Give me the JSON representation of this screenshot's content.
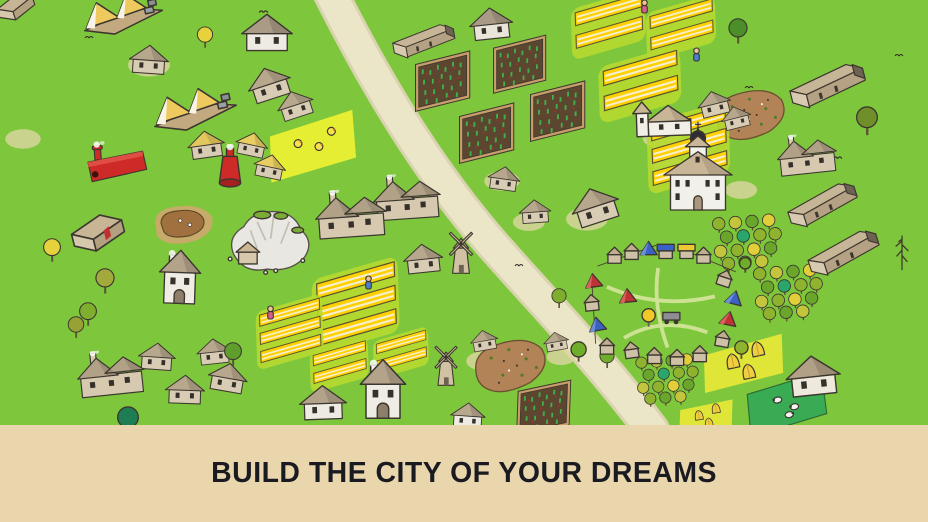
{
  "banner": {
    "text": "BUILD THE CITY OF YOUR DREAMS",
    "bg_color": "#e9d6ac",
    "text_color": "#1a1a21"
  },
  "map": {
    "grass_color": "#7ec73d",
    "road_color": "#ece6c8",
    "road_edge_color": "#d9d3b0",
    "road_path": "M 328,-12 C 376,84 428,170 492,244 C 550,310 596,356 652,430",
    "objects": [
      {
        "t": "patch",
        "x": 120,
        "y": 52,
        "w": 58,
        "h": 26
      },
      {
        "t": "patch",
        "x": 0,
        "y": 128,
        "w": 46,
        "h": 22
      },
      {
        "t": "patch",
        "x": 478,
        "y": 170,
        "w": 48,
        "h": 22
      },
      {
        "t": "patch",
        "x": 506,
        "y": 212,
        "w": 46,
        "h": 20
      },
      {
        "t": "patch",
        "x": 556,
        "y": 206,
        "w": 62,
        "h": 26
      },
      {
        "t": "patch",
        "x": 634,
        "y": 126,
        "w": 56,
        "h": 24
      },
      {
        "t": "patch",
        "x": 692,
        "y": 102,
        "w": 62,
        "h": 26
      },
      {
        "t": "patch",
        "x": 646,
        "y": 156,
        "w": 46,
        "h": 20
      },
      {
        "t": "patch",
        "x": 716,
        "y": 180,
        "w": 50,
        "h": 20
      },
      {
        "t": "patch",
        "x": 458,
        "y": 350,
        "w": 52,
        "h": 22
      },
      {
        "t": "patch",
        "x": 540,
        "y": 348,
        "w": 42,
        "h": 18
      },
      {
        "t": "mudpit",
        "x": 150,
        "y": 198,
        "w": 66,
        "h": 52,
        "r": 0
      },
      {
        "t": "dirt",
        "x": 706,
        "y": 86,
        "w": 88,
        "h": 58,
        "r": -8
      },
      {
        "t": "dirt",
        "x": 466,
        "y": 336,
        "w": 88,
        "h": 60,
        "r": -10
      },
      {
        "t": "crop",
        "x": 402,
        "y": 56,
        "w": 80,
        "h": 52,
        "r": -14
      },
      {
        "t": "crop",
        "x": 480,
        "y": 40,
        "w": 78,
        "h": 50,
        "r": -14
      },
      {
        "t": "crop",
        "x": 446,
        "y": 108,
        "w": 80,
        "h": 52,
        "r": -14
      },
      {
        "t": "crop",
        "x": 516,
        "y": 86,
        "w": 82,
        "h": 52,
        "r": -14
      },
      {
        "t": "crop",
        "x": 500,
        "y": 384,
        "w": 86,
        "h": 50,
        "r": -12
      },
      {
        "t": "chickfield",
        "x": 262,
        "y": 118,
        "w": 102,
        "h": 58,
        "r": -14
      },
      {
        "t": "wheat3",
        "x": 294,
        "y": 268,
        "w": 114,
        "h": 78,
        "r": -16
      },
      {
        "t": "wheat3",
        "x": 242,
        "y": 298,
        "w": 88,
        "h": 70,
        "r": -16
      },
      {
        "t": "wheat3",
        "x": 608,
        "y": 114,
        "w": 152,
        "h": 70,
        "r": -16
      },
      {
        "t": "wheat2",
        "x": 556,
        "y": -6,
        "w": 94,
        "h": 64,
        "r": -16
      },
      {
        "t": "wheat2",
        "x": 632,
        "y": -2,
        "w": 88,
        "h": 62,
        "r": -16
      },
      {
        "t": "wheat2",
        "x": 582,
        "y": 56,
        "w": 104,
        "h": 60,
        "r": -16
      },
      {
        "t": "wheat2",
        "x": 298,
        "y": 338,
        "w": 74,
        "h": 56,
        "r": -16
      },
      {
        "t": "wheat2",
        "x": 362,
        "y": 328,
        "w": 70,
        "h": 52,
        "r": -16
      },
      {
        "t": "hayfield",
        "x": 698,
        "y": 340,
        "w": 94,
        "h": 46,
        "r": -12
      },
      {
        "t": "hayfield",
        "x": 668,
        "y": 402,
        "w": 78,
        "h": 30,
        "r": -8
      },
      {
        "t": "pasture",
        "x": 738,
        "y": 378,
        "w": 98,
        "h": 52,
        "r": -12
      },
      {
        "t": "orchard",
        "x": 706,
        "y": 212,
        "w": 84,
        "h": 64,
        "r": -4
      },
      {
        "t": "orchard",
        "x": 746,
        "y": 262,
        "w": 86,
        "h": 64,
        "r": -4
      },
      {
        "t": "orchard",
        "x": 626,
        "y": 352,
        "w": 84,
        "h": 58,
        "r": -4
      },
      {
        "t": "shed",
        "x": -4,
        "y": -8,
        "w": 40,
        "h": 30,
        "r": -18
      },
      {
        "t": "tent",
        "x": 76,
        "y": -8,
        "w": 92,
        "h": 42,
        "r": -12
      },
      {
        "t": "tent",
        "x": 148,
        "y": 86,
        "w": 92,
        "h": 44,
        "r": -12
      },
      {
        "t": "house",
        "x": 128,
        "y": 42,
        "w": 42,
        "h": 34,
        "r": 4
      },
      {
        "t": "house",
        "x": 240,
        "y": 8,
        "w": 54,
        "h": 48,
        "r": 0,
        "c": {
          "wall": "#eeebe3",
          "roof": "#a99b86"
        }
      },
      {
        "t": "house",
        "x": 244,
        "y": 64,
        "w": 50,
        "h": 38,
        "r": -18
      },
      {
        "t": "house",
        "x": 274,
        "y": 88,
        "w": 42,
        "h": 32,
        "r": -18
      },
      {
        "t": "longbarn",
        "x": 388,
        "y": 20,
        "w": 72,
        "h": 44,
        "r": -10
      },
      {
        "t": "house",
        "x": 468,
        "y": 2,
        "w": 46,
        "h": 42,
        "r": -6,
        "c": {
          "wall": "#e9e5db",
          "roof": "#a89a85"
        }
      },
      {
        "t": "house",
        "x": 186,
        "y": 128,
        "w": 40,
        "h": 32,
        "r": -8,
        "c": {
          "roof": "#e3c85e"
        }
      },
      {
        "t": "house",
        "x": 234,
        "y": 130,
        "w": 36,
        "h": 28,
        "r": 12,
        "c": {
          "roof": "#e8cd62"
        }
      },
      {
        "t": "house",
        "x": 252,
        "y": 152,
        "w": 36,
        "h": 28,
        "r": 12,
        "c": {
          "roof": "#e8cd62"
        }
      },
      {
        "t": "factory",
        "x": 84,
        "y": 138,
        "w": 68,
        "h": 54,
        "r": -4
      },
      {
        "t": "kiln",
        "x": 214,
        "y": 144,
        "w": 32,
        "h": 46,
        "r": 0
      },
      {
        "t": "shed",
        "x": 70,
        "y": 212,
        "w": 56,
        "h": 42,
        "r": -14,
        "c": {
          "door": "#c03030"
        }
      },
      {
        "t": "quarry",
        "x": 220,
        "y": 202,
        "w": 98,
        "h": 80,
        "r": 0
      },
      {
        "t": "tallhouse",
        "x": 156,
        "y": 242,
        "w": 48,
        "h": 68,
        "r": 2
      },
      {
        "t": "bighouse",
        "x": 314,
        "y": 184,
        "w": 74,
        "h": 64,
        "r": -4
      },
      {
        "t": "bighouse",
        "x": 372,
        "y": 170,
        "w": 70,
        "h": 58,
        "r": -4
      },
      {
        "t": "house",
        "x": 402,
        "y": 240,
        "w": 42,
        "h": 36,
        "r": -6
      },
      {
        "t": "windmill",
        "x": 440,
        "y": 226,
        "w": 42,
        "h": 54,
        "r": 0
      },
      {
        "t": "house",
        "x": 486,
        "y": 164,
        "w": 36,
        "h": 28,
        "r": 8
      },
      {
        "t": "house",
        "x": 518,
        "y": 196,
        "w": 34,
        "h": 30,
        "r": -4
      },
      {
        "t": "house",
        "x": 568,
        "y": 184,
        "w": 54,
        "h": 42,
        "r": -18
      },
      {
        "t": "chapel",
        "x": 632,
        "y": 94,
        "w": 64,
        "h": 48,
        "r": -2
      },
      {
        "t": "church",
        "x": 656,
        "y": 120,
        "w": 84,
        "h": 100,
        "r": 0
      },
      {
        "t": "house",
        "x": 696,
        "y": 88,
        "w": 36,
        "h": 30,
        "r": -14
      },
      {
        "t": "house",
        "x": 720,
        "y": 104,
        "w": 32,
        "h": 26,
        "r": -14
      },
      {
        "t": "longbarn",
        "x": 784,
        "y": 62,
        "w": 88,
        "h": 50,
        "r": -14
      },
      {
        "t": "bighouse",
        "x": 776,
        "y": 126,
        "w": 62,
        "h": 60,
        "r": -6
      },
      {
        "t": "longbarn",
        "x": 782,
        "y": 180,
        "w": 82,
        "h": 52,
        "r": -18
      },
      {
        "t": "longbarn",
        "x": 802,
        "y": 228,
        "w": 84,
        "h": 52,
        "r": -18
      },
      {
        "t": "market",
        "x": 562,
        "y": 232,
        "w": 196,
        "h": 142,
        "r": 0
      },
      {
        "t": "bighouse",
        "x": 76,
        "y": 344,
        "w": 70,
        "h": 62,
        "r": -6
      },
      {
        "t": "house",
        "x": 136,
        "y": 340,
        "w": 42,
        "h": 32,
        "r": 4
      },
      {
        "t": "house",
        "x": 194,
        "y": 336,
        "w": 40,
        "h": 30,
        "r": -6
      },
      {
        "t": "house",
        "x": 164,
        "y": 372,
        "w": 42,
        "h": 34,
        "r": 2
      },
      {
        "t": "house",
        "x": 206,
        "y": 360,
        "w": 44,
        "h": 34,
        "r": 10
      },
      {
        "t": "house",
        "x": 298,
        "y": 380,
        "w": 50,
        "h": 44,
        "r": -2,
        "c": {
          "wall": "#eeebe3",
          "roof": "#b3a38b"
        }
      },
      {
        "t": "tallhouse",
        "x": 356,
        "y": 354,
        "w": 54,
        "h": 68,
        "r": 0
      },
      {
        "t": "windmill",
        "x": 426,
        "y": 340,
        "w": 40,
        "h": 52,
        "r": 0
      },
      {
        "t": "house",
        "x": 446,
        "y": 400,
        "w": 44,
        "h": 30,
        "r": 4,
        "c": {
          "wall": "#eeebe3"
        }
      },
      {
        "t": "house",
        "x": 468,
        "y": 328,
        "w": 32,
        "h": 24,
        "r": -10
      },
      {
        "t": "house",
        "x": 542,
        "y": 330,
        "w": 28,
        "h": 22,
        "r": -10
      },
      {
        "t": "house",
        "x": 784,
        "y": 348,
        "w": 58,
        "h": 54,
        "r": -6,
        "c": {
          "wall": "#efe9dd",
          "roof": "#b2a086"
        }
      },
      {
        "t": "tree",
        "x": 196,
        "y": 26,
        "w": 18,
        "h": 24,
        "c": {
          "leaf": "#e5d23c"
        }
      },
      {
        "t": "tree",
        "x": 42,
        "y": 238,
        "w": 20,
        "h": 26,
        "c": {
          "leaf": "#e5d23c"
        }
      },
      {
        "t": "tree",
        "x": 94,
        "y": 268,
        "w": 22,
        "h": 28,
        "c": {
          "leaf": "#a3a93a"
        }
      },
      {
        "t": "tree",
        "x": 78,
        "y": 302,
        "w": 20,
        "h": 26,
        "c": {
          "leaf": "#7fae2f"
        }
      },
      {
        "t": "tree",
        "x": 66,
        "y": 316,
        "w": 20,
        "h": 24,
        "c": {
          "leaf": "#97a135"
        }
      },
      {
        "t": "tree",
        "x": 222,
        "y": 342,
        "w": 22,
        "h": 26,
        "c": {
          "leaf": "#5f9e2d"
        }
      },
      {
        "t": "tree",
        "x": 114,
        "y": 406,
        "w": 28,
        "h": 32,
        "c": {
          "leaf": "#1f7d54"
        }
      },
      {
        "t": "tree",
        "x": 726,
        "y": 18,
        "w": 24,
        "h": 28,
        "c": {
          "leaf": "#4c8f28"
        }
      },
      {
        "t": "tree",
        "x": 854,
        "y": 106,
        "w": 26,
        "h": 32,
        "c": {
          "leaf": "#6f8f2b"
        }
      },
      {
        "t": "pine",
        "x": 892,
        "y": 228,
        "w": 20,
        "h": 46
      },
      {
        "t": "tree",
        "x": 550,
        "y": 288,
        "w": 18,
        "h": 22,
        "c": {
          "leaf": "#7fae2f"
        }
      },
      {
        "t": "tree",
        "x": 598,
        "y": 348,
        "w": 18,
        "h": 22,
        "c": {
          "leaf": "#6fae2a"
        }
      },
      {
        "t": "farmer",
        "x": 638,
        "y": -2,
        "w": 13,
        "h": 17,
        "c": {
          "shirt": "#d85b8a"
        }
      },
      {
        "t": "farmer",
        "x": 690,
        "y": 46,
        "w": 13,
        "h": 17,
        "c": {
          "shirt": "#4a7fd4"
        }
      },
      {
        "t": "farmer",
        "x": 362,
        "y": 274,
        "w": 13,
        "h": 17,
        "c": {
          "shirt": "#4a7fd4"
        }
      },
      {
        "t": "farmer",
        "x": 264,
        "y": 304,
        "w": 13,
        "h": 17,
        "c": {
          "shirt": "#d85b8a"
        }
      },
      {
        "t": "speck",
        "x": 258,
        "y": 8,
        "w": 11,
        "h": 7
      },
      {
        "t": "speck",
        "x": 84,
        "y": 34,
        "w": 10,
        "h": 6
      },
      {
        "t": "speck",
        "x": 832,
        "y": 154,
        "w": 11,
        "h": 7
      },
      {
        "t": "speck",
        "x": 514,
        "y": 262,
        "w": 10,
        "h": 6
      },
      {
        "t": "speck",
        "x": 744,
        "y": 84,
        "w": 10,
        "h": 6
      },
      {
        "t": "speck",
        "x": 894,
        "y": 52,
        "w": 10,
        "h": 6
      }
    ]
  }
}
